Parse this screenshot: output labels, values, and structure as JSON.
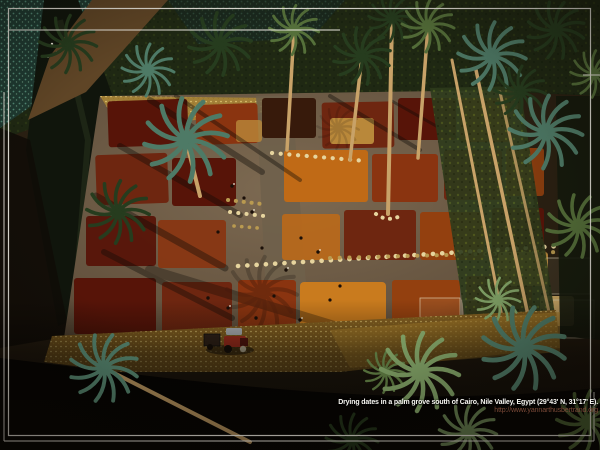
{
  "caption": {
    "text": "Drying dates in a palm grove south of Cairo, Nile Valley, Egypt (29°43' N, 31°17' E).",
    "url": "http://www.yannarthusbertrand.org"
  },
  "scene": {
    "description": "Aerial view of a rectangular drying yard among date palms: colored patches of dates, rows of pale baskets, workers, a red tractor, irrigation canal and teal crop fields at top-left, dense palm canopy elsewhere, dark shadowed foreground",
    "elements": [
      "palm-canopy",
      "crop-fields",
      "irrigation-canal",
      "dirt-banks",
      "drying-yard",
      "date-patches",
      "basket-rows",
      "workers",
      "tree-shadows",
      "right-grove",
      "golden-grass",
      "tractor",
      "foreground-shadow",
      "palm-crowns",
      "slide-frame"
    ]
  },
  "palette": {
    "field_teal": "#1f3c34",
    "field_speckle": "#56907c",
    "maroon": "#571408",
    "rust": "#8a3410",
    "rust2": "#6e2610",
    "orange": "#c06a16",
    "orange2": "#c97b1e",
    "brick": "#93400f",
    "dark_patch": "#371a0b",
    "amber": "#b9883a",
    "sand": "#d4ae66",
    "basket": "#e6d49e",
    "basket_dim": "#b99a50",
    "trunk": "#c8a268",
    "palm_dark": "#263c1e",
    "palm_green": "#55703a",
    "palm_teal": "#4e7a66",
    "palm_bright": "#7fa065",
    "tractor_red": "#b23220",
    "tractor_roof": "#b9bec2",
    "frame": "#f2efe6",
    "caption": "#f7f6f1",
    "url": "#7c4a38"
  }
}
